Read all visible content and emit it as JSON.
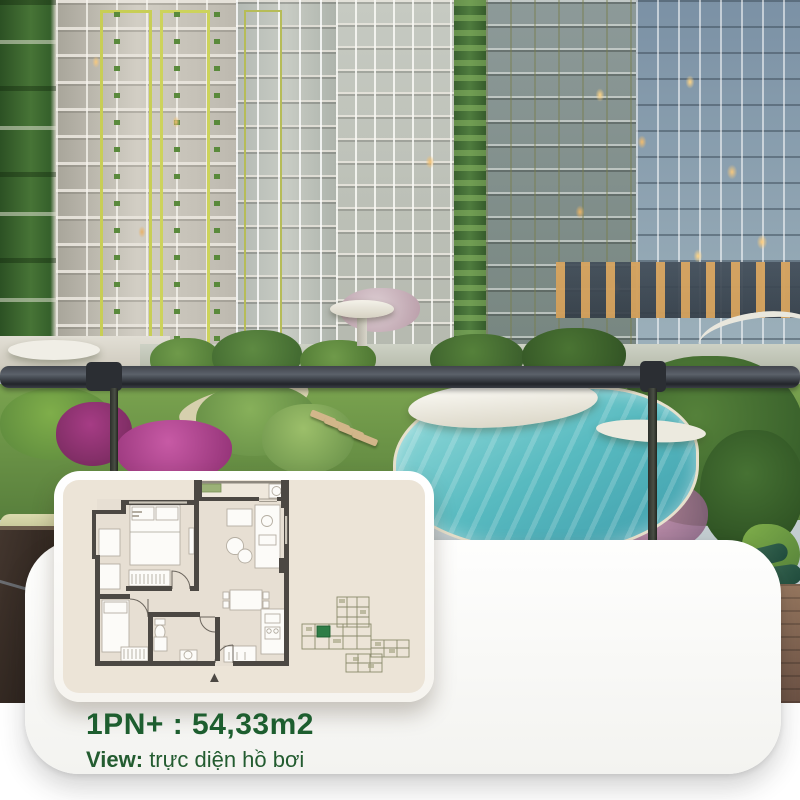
{
  "info_card": {
    "unit_title": "1PN+ : 54,33m2",
    "view_label": "View:",
    "view_value": "trực diện hồ bơi"
  },
  "floor_plan": {
    "entrance_arrow": "▲"
  },
  "watermark": {
    "line1": "ở vị",
    "line2": "nghiê"
  },
  "colors": {
    "title_green": "#1d5e2f",
    "highlight_unit_green": "#2e7d46",
    "plan_wall": "#4c4843",
    "plan_panel_bg": "#ece4d7",
    "card_bg": "#fdfdfc",
    "pool_teal": "#58bac0"
  }
}
